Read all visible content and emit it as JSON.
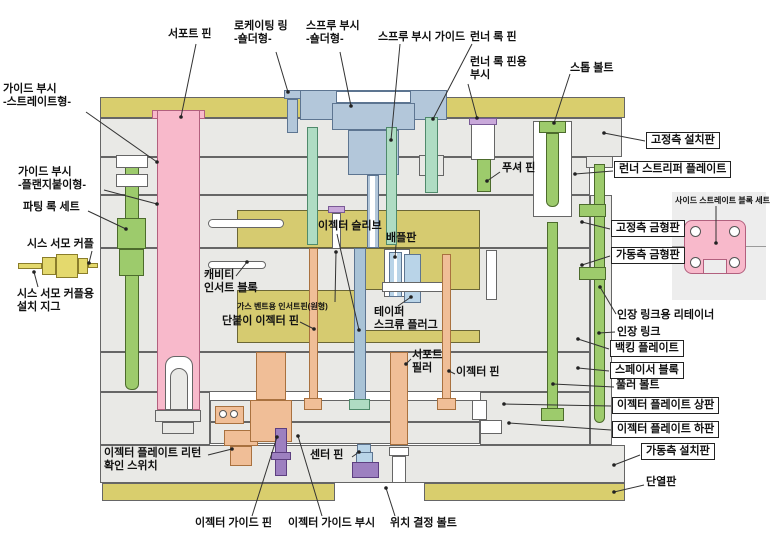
{
  "diagram": {
    "type": "injection-mold-cross-section-diagram",
    "language": "ko",
    "colors": {
      "plate_gray": "#e9e9e6",
      "insulation_yellow": "#d9ce6d",
      "insert_yellow": "#d6cb70",
      "pink": "#f8b9cb",
      "green": "#9dcb6c",
      "teal": "#afdcc3",
      "blue": "#b3c7da",
      "light_blue": "#b9d4e8",
      "salmon": "#f0be97",
      "purple": "#9d80c0",
      "lavender": "#c9a9da",
      "leader_line": "#333333"
    },
    "labels": [
      {
        "id": "support-pin",
        "text": "서포트 핀",
        "x": 168,
        "y": 28,
        "line": [
          196,
          44,
          181,
          117
        ]
      },
      {
        "id": "locating-ring",
        "text": "로케이팅 링\n-숄더형-",
        "x": 234,
        "y": 20,
        "line": [
          276,
          52,
          288,
          92
        ]
      },
      {
        "id": "sprue-bush",
        "text": "스프루 부시\n-숄더형-",
        "x": 306,
        "y": 20,
        "line": [
          340,
          52,
          351,
          106
        ]
      },
      {
        "id": "sprue-bush-guide",
        "text": "스프루 부시 가이드",
        "x": 378,
        "y": 31,
        "line": [
          400,
          44,
          391,
          140
        ]
      },
      {
        "id": "runner-lock-pin",
        "text": "런너 록 핀",
        "x": 470,
        "y": 31,
        "line": [
          472,
          44,
          433,
          119
        ]
      },
      {
        "id": "runner-lock-pin-bush",
        "text": "런너 록 핀용\n부시",
        "x": 470,
        "y": 56,
        "line": [
          468,
          84,
          477,
          118
        ]
      },
      {
        "id": "stop-bolt",
        "text": "스톱 볼트",
        "x": 570,
        "y": 62,
        "line": [
          570,
          74,
          554,
          123
        ]
      },
      {
        "id": "guide-bush-straight",
        "text": "가이드 부시\n-스트레이트형-",
        "x": 3,
        "y": 83,
        "line": [
          86,
          112,
          157,
          162
        ]
      },
      {
        "id": "guide-bush-flange",
        "text": "가이드 부시\n-플랜지붙이형-",
        "x": 18,
        "y": 166,
        "line": [
          104,
          190,
          157,
          204
        ]
      },
      {
        "id": "parting-lock-set",
        "text": "파팅 록 세트",
        "x": 23,
        "y": 201,
        "line": [
          88,
          211,
          126,
          229
        ]
      },
      {
        "id": "sheath-thermocouple",
        "text": "시스 서모 커플",
        "x": 27,
        "y": 238,
        "line": [
          92,
          251,
          89,
          263
        ]
      },
      {
        "id": "thermocouple-jig",
        "text": "시스 서모 커플용\n설치 지그",
        "x": 17,
        "y": 288,
        "line": [
          38,
          287,
          34,
          272
        ]
      },
      {
        "id": "pusher-pin",
        "text": "푸셔 핀",
        "x": 502,
        "y": 162,
        "line": [
          500,
          172,
          487,
          181
        ]
      },
      {
        "id": "ejector-sleeve",
        "text": "이젝터 슬리브",
        "x": 318,
        "y": 220,
        "line": [
          337,
          234,
          359,
          330
        ]
      },
      {
        "id": "baffle-plate",
        "text": "배플판",
        "x": 386,
        "y": 232,
        "line": [
          396,
          245,
          395,
          257
        ]
      },
      {
        "id": "cavity-insert-block",
        "text": "캐비티\n인서트 블록",
        "x": 204,
        "y": 269,
        "line": [
          236,
          276,
          247,
          262
        ]
      },
      {
        "id": "gas-vent-insert-pin",
        "text": "가스 벤트용 인서트핀(원형)",
        "x": 237,
        "y": 302,
        "small": true,
        "line": [
          335,
          302,
          336,
          252
        ]
      },
      {
        "id": "stepped-ejector-pin",
        "text": "단붙이 이젝터 핀",
        "x": 222,
        "y": 315,
        "line": [
          300,
          322,
          314,
          329
        ]
      },
      {
        "id": "taper-screw-plug",
        "text": "테이퍼\n스크류 플러그",
        "x": 374,
        "y": 306,
        "line": [
          398,
          306,
          411,
          297
        ]
      },
      {
        "id": "support-pillar",
        "text": "서포트\n필러",
        "x": 412,
        "y": 349,
        "line": [
          411,
          359,
          406,
          364
        ]
      },
      {
        "id": "ejector-pin",
        "text": "이젝터 핀",
        "x": 456,
        "y": 366,
        "line": [
          455,
          374,
          449,
          371
        ]
      },
      {
        "id": "ejector-return-switch",
        "text": "이젝터 플레이트 리턴\n확인 스위치",
        "x": 104,
        "y": 447,
        "line": [
          208,
          455,
          232,
          449
        ]
      },
      {
        "id": "ejector-guide-pin",
        "text": "이젝터 가이드 핀",
        "x": 195,
        "y": 517,
        "line": [
          252,
          516,
          277,
          437
        ]
      },
      {
        "id": "ejector-guide-bush",
        "text": "이젝터 가이드 부시",
        "x": 288,
        "y": 517,
        "line": [
          322,
          516,
          298,
          436
        ]
      },
      {
        "id": "center-pin",
        "text": "센터 핀",
        "x": 310,
        "y": 449,
        "line": [
          352,
          457,
          359,
          452
        ]
      },
      {
        "id": "positioning-bolt",
        "text": "위치 결정 볼트",
        "x": 390,
        "y": 517,
        "line": [
          395,
          516,
          386,
          488
        ]
      },
      {
        "id": "fixed-clamp-plate",
        "text": "고정측 설치판",
        "x": 646,
        "y": 132,
        "boxed": true,
        "line": [
          645,
          141,
          604,
          133
        ]
      },
      {
        "id": "runner-stripper-plate",
        "text": "런너 스트리퍼 플레이트",
        "x": 614,
        "y": 161,
        "boxed": true,
        "line": [
          613,
          171,
          575,
          174
        ]
      },
      {
        "id": "fixed-mold-plate",
        "text": "고정측 금형판",
        "x": 611,
        "y": 220,
        "boxed": true,
        "line": [
          610,
          229,
          582,
          222
        ]
      },
      {
        "id": "movable-mold-plate",
        "text": "가동측 금형판",
        "x": 611,
        "y": 247,
        "boxed": true,
        "line": [
          610,
          256,
          582,
          265
        ]
      },
      {
        "id": "tension-link-retainer",
        "text": "인장 링크용 리테이너",
        "x": 617,
        "y": 309,
        "line": [
          616,
          314,
          600,
          287
        ]
      },
      {
        "id": "tension-link",
        "text": "인장 링크",
        "x": 617,
        "y": 326,
        "line": [
          615,
          332,
          599,
          333
        ]
      },
      {
        "id": "backing-plate",
        "text": "백킹 플레이트",
        "x": 610,
        "y": 340,
        "boxed": true,
        "line": [
          609,
          349,
          578,
          339
        ]
      },
      {
        "id": "spacer-block",
        "text": "스페이서 블록",
        "x": 610,
        "y": 362,
        "boxed": true,
        "line": [
          609,
          371,
          578,
          368
        ]
      },
      {
        "id": "puller-bolt",
        "text": "풀러 볼트",
        "x": 616,
        "y": 379,
        "line": [
          614,
          387,
          553,
          384
        ]
      },
      {
        "id": "ejector-plate-upper",
        "text": "이젝터 플레이트 상판",
        "x": 612,
        "y": 397,
        "boxed": true,
        "line": [
          611,
          406,
          504,
          404
        ]
      },
      {
        "id": "ejector-plate-lower",
        "text": "이젝터 플레이트 하판",
        "x": 612,
        "y": 421,
        "boxed": true,
        "line": [
          611,
          430,
          509,
          423
        ]
      },
      {
        "id": "movable-clamp-plate",
        "text": "가동측 설치판",
        "x": 641,
        "y": 443,
        "boxed": true,
        "line": [
          640,
          455,
          614,
          465
        ]
      },
      {
        "id": "insulation-plate",
        "text": "단열판",
        "x": 646,
        "y": 476,
        "line": [
          644,
          485,
          614,
          492
        ]
      },
      {
        "id": "side-straight-block-set",
        "text": "사이드 스트레이트 블록 세트",
        "x": 675,
        "y": 196,
        "small": true,
        "line": [
          716,
          206,
          716,
          243
        ]
      }
    ]
  }
}
